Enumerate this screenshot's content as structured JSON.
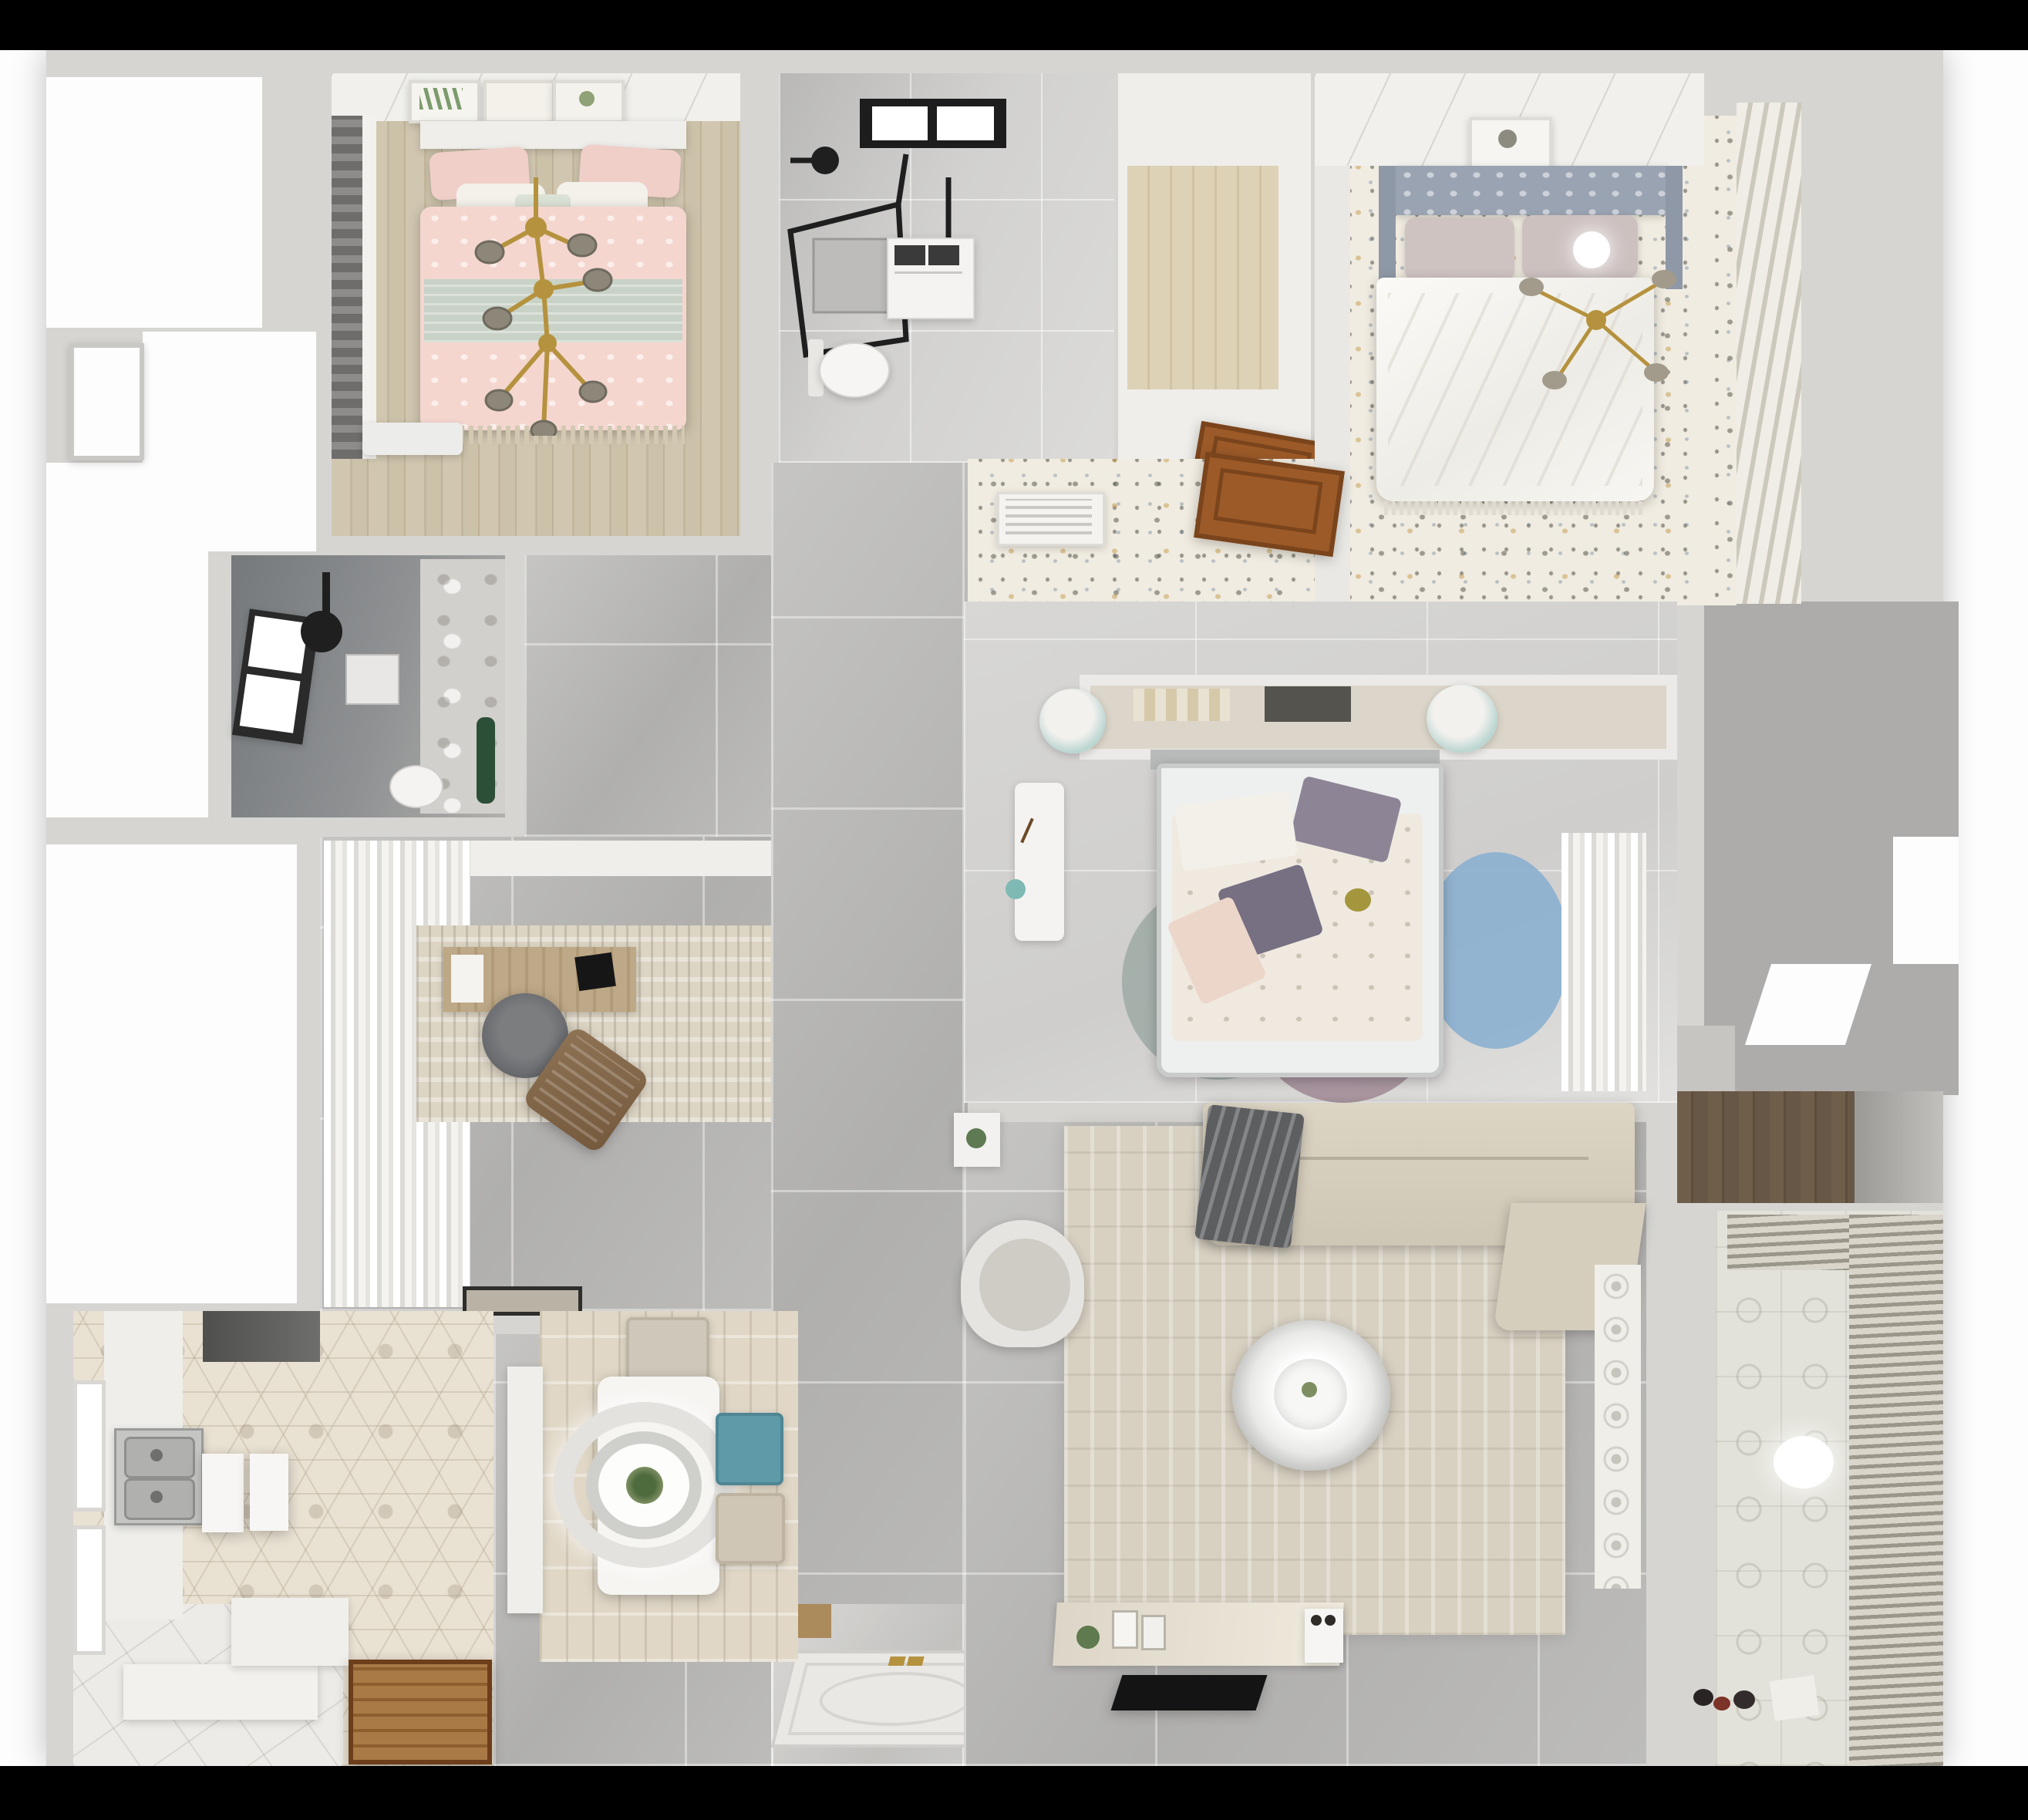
{
  "title": "Top-down 3D rendered apartment floor plan (no visible text)",
  "background": {
    "top_band": "#000000",
    "bottom_band": "#000000",
    "surround": "#fdfdfd",
    "walls": "#d6d5d2"
  },
  "palette": {
    "gray_tile": "#b8b7b5",
    "light_tile": "#d5d4d2",
    "wood_floor": "#cdc3ab",
    "dark_wood": "#655543",
    "speckle_floor": "#f1ece1",
    "hex_tile": "#e9e1d2",
    "white_tile": "#edebe7",
    "bath_dark": "#84878a",
    "pink_bed": "#f4d6cf",
    "sage_throw": "#c9d2c7",
    "gold_accent": "#b5923e",
    "teal_chair": "#5f9aa8",
    "mint_pouf": "#bcd6d2",
    "blue_rug": "#86aed0",
    "mauve_rug": "#a08a95",
    "sofa_beige": "#d8d0bf",
    "blanket_gray": "#5c5e60",
    "door_wood": "#9c5a28",
    "tv_black": "#141414"
  },
  "rooms": [
    {
      "name": "bedroom-1",
      "position": "top-left",
      "floor": "light wood planks",
      "items": [
        "three botanical art frames",
        "pink double bed with sage throw",
        "pink and white pillows",
        "gold branch chandelier",
        "dark roman blind window",
        "white bench"
      ]
    },
    {
      "name": "bathroom-1",
      "position": "top-center",
      "floor": "gray tile",
      "items": [
        "black framed skylight",
        "black glass shower enclosure",
        "shower head",
        "washing machine",
        "toilet"
      ]
    },
    {
      "name": "walk-in-closet",
      "position": "top-center-right",
      "floor": "wood planks",
      "items": [
        "white shelving perimeter",
        "open wood door"
      ]
    },
    {
      "name": "bedroom-2",
      "position": "top-right",
      "floor": "speckled terrazzo / floral paper",
      "items": [
        "gray tufted headboard",
        "blush pillows",
        "white duvet",
        "white globe lamp",
        "gold ceiling fan",
        "art frame",
        "slatted shutter wardrobe",
        "AC louver vent",
        "open wood door"
      ]
    },
    {
      "name": "bathroom-2",
      "position": "mid-left",
      "floor": "dark gray tile",
      "items": [
        "tilted window",
        "black shower set",
        "shower tray",
        "toilet",
        "marble wall",
        "green plant"
      ]
    },
    {
      "name": "study",
      "position": "center-left",
      "floor": "gray tile",
      "items": [
        "wavy white curtains",
        "distressed beige rug",
        "wood desk",
        "laptop",
        "gray office chair",
        "brown lounge chair",
        "doormat"
      ]
    },
    {
      "name": "bedroom-3",
      "position": "center",
      "floor": "soft light tile",
      "items": [
        "white headboard shelf with books",
        "two mint poufs",
        "bed with floral duvet and purple pillows",
        "overlapping circle rug (blue, mauve, sage)",
        "white desk",
        "sheer curtain wardrobe",
        "corridor wardrobe niche"
      ]
    },
    {
      "name": "kitchen",
      "position": "bottom-left",
      "floor": "hexagon tile + white tile",
      "items": [
        "double stainless sink",
        "range hood",
        "two windows",
        "white island slabs",
        "white counters",
        "wood door"
      ]
    },
    {
      "name": "dining",
      "position": "bottom-center-left",
      "floor": "wood-look rug over gray tile",
      "items": [
        "white dining table",
        "round double-ring pendant with plant",
        "beige chair",
        "teal chair",
        "beige chair",
        "white bench"
      ]
    },
    {
      "name": "living",
      "position": "bottom-center-right",
      "floor": "gray tile",
      "items": [
        "L-shaped beige sofa with gray blanket",
        "large beige rug",
        "round two-tier coffee table",
        "armchair",
        "side table with plant",
        "TV console with decor",
        "flat black TV panel",
        "lace panel"
      ]
    },
    {
      "name": "entry",
      "position": "bottom-center",
      "items": [
        "ornate entrance door with gold handles",
        "wood threshold"
      ]
    },
    {
      "name": "balcony",
      "position": "bottom-right",
      "floor": "patterned tile",
      "items": [
        "venetian blinds",
        "glowing ceiling lamp",
        "small toys"
      ]
    },
    {
      "name": "storage-niche",
      "position": "right",
      "floor": "dark wood",
      "items": []
    },
    {
      "name": "structural-void",
      "position": "right-middle",
      "items": [
        "gray shaft area",
        "white cutouts"
      ]
    }
  ]
}
